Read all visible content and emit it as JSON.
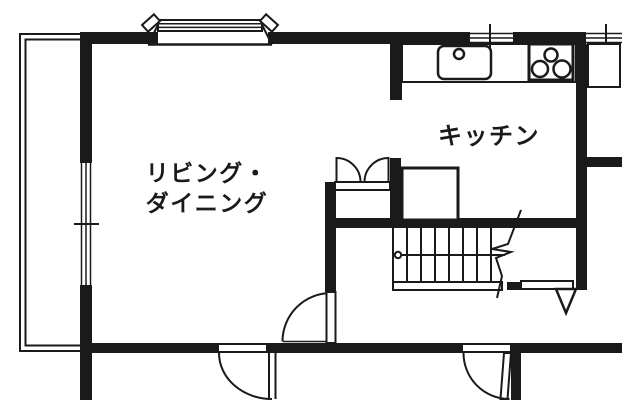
{
  "page": {
    "background": "#ffffff",
    "ink": "#1a1a1a"
  },
  "floor_plan": {
    "labels": {
      "living_dining_line1": "リビング・",
      "living_dining_line2": "ダイニング",
      "kitchen": "キッチン"
    },
    "rooms": [
      {
        "id": "living-dining",
        "name": "リビング・ダイニング"
      },
      {
        "id": "kitchen",
        "name": "キッチン"
      }
    ],
    "features": [
      "balcony-outline",
      "bay-window",
      "sliding-window",
      "left-wall-window",
      "kitchen-counter",
      "kitchen-sink-icon",
      "gas-stove-3-burner-icon",
      "refrigerator-space",
      "side-cabinet",
      "double-door-closet",
      "staircase-with-break-line",
      "stair-direction-line",
      "hinged-door-bottom-left",
      "hinged-door-bottom-right",
      "hinged-door-living-to-hall",
      "entrance-triangle-marker"
    ]
  }
}
